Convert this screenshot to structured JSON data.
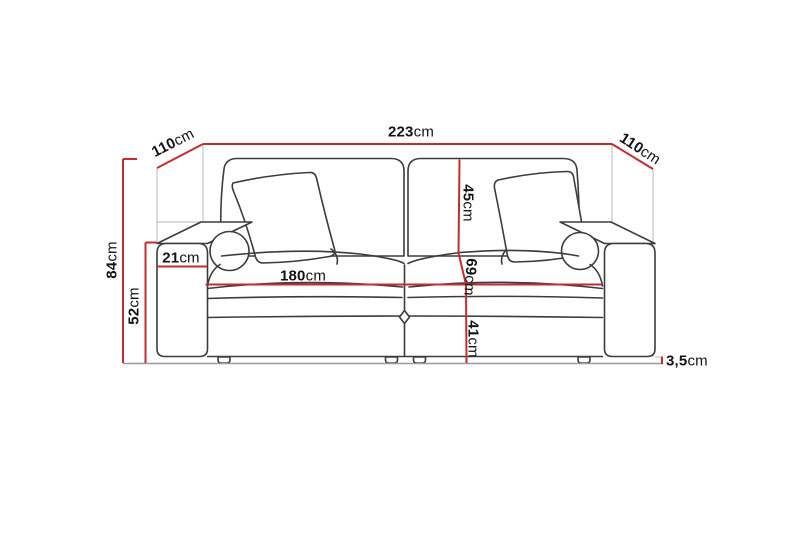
{
  "diagram": {
    "kind": "sofa-dimension-drawing",
    "colors": {
      "dimension": "#c62b2e",
      "outline": "#3c3c3c",
      "guide": "#b9b9b9",
      "floor": "#9a9a9a",
      "text": "#141414"
    },
    "labels": {
      "total_width": {
        "value": "223",
        "unit": "cm"
      },
      "depth_left": {
        "value": "110",
        "unit": "cm"
      },
      "depth_right": {
        "value": "110",
        "unit": "cm"
      },
      "total_height": {
        "value": "84",
        "unit": "cm"
      },
      "armrest_height": {
        "value": "52",
        "unit": "cm"
      },
      "armrest_width": {
        "value": "21",
        "unit": "cm"
      },
      "seat_width": {
        "value": "180",
        "unit": "cm"
      },
      "backrest_height": {
        "value": "45",
        "unit": "cm"
      },
      "seat_depth": {
        "value": "69",
        "unit": "cm"
      },
      "seat_height": {
        "value": "41",
        "unit": "cm"
      },
      "leg_height": {
        "value": "3,5",
        "unit": "cm"
      }
    }
  }
}
